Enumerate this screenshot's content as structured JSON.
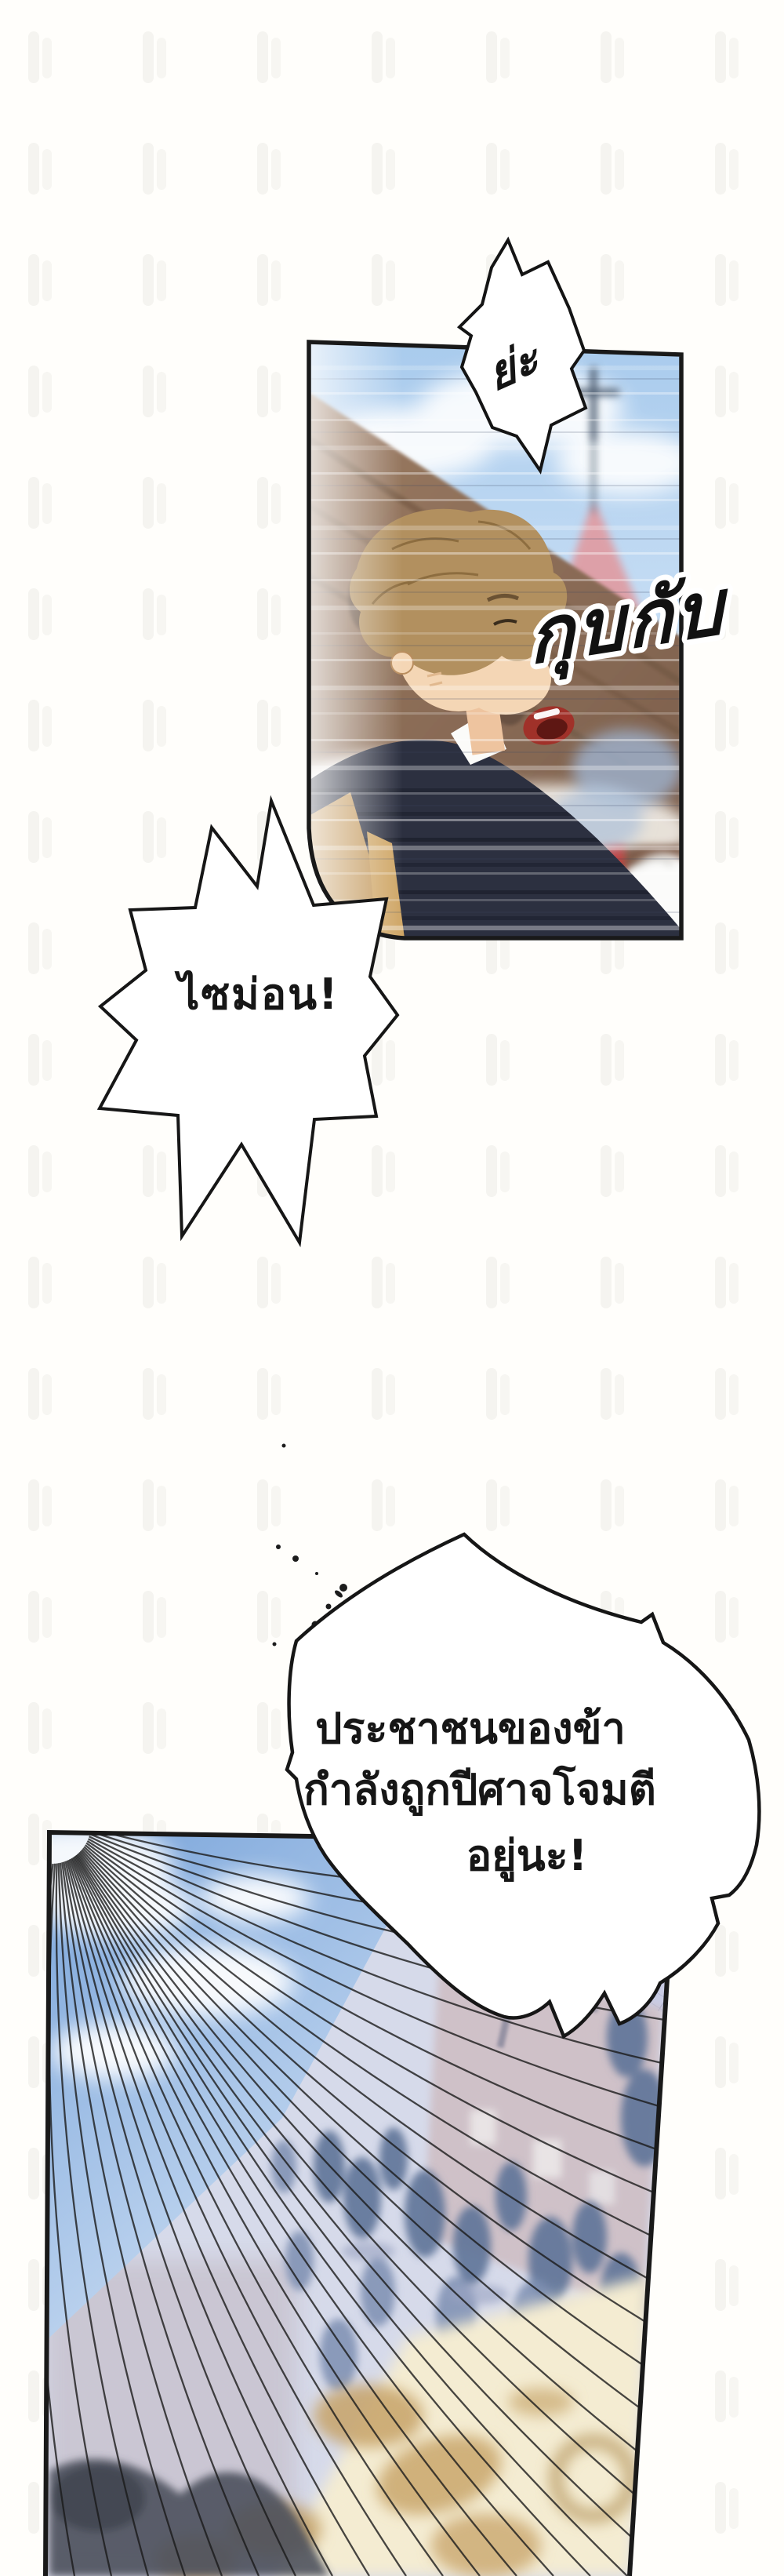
{
  "page": {
    "background": "#fffefb",
    "ink": "#191919",
    "paper": "#ffffff"
  },
  "bubbles": {
    "burst": {
      "text": "ย่ะ"
    },
    "simon": {
      "text": "ไซม่อน!"
    },
    "plea": {
      "line1": "ประชาชนของข้า",
      "line2": "กำลังถูกปีศาจโจมตี",
      "line3": "อยู่นะ!"
    }
  },
  "sfx": {
    "gallop": "กุบกับ"
  }
}
